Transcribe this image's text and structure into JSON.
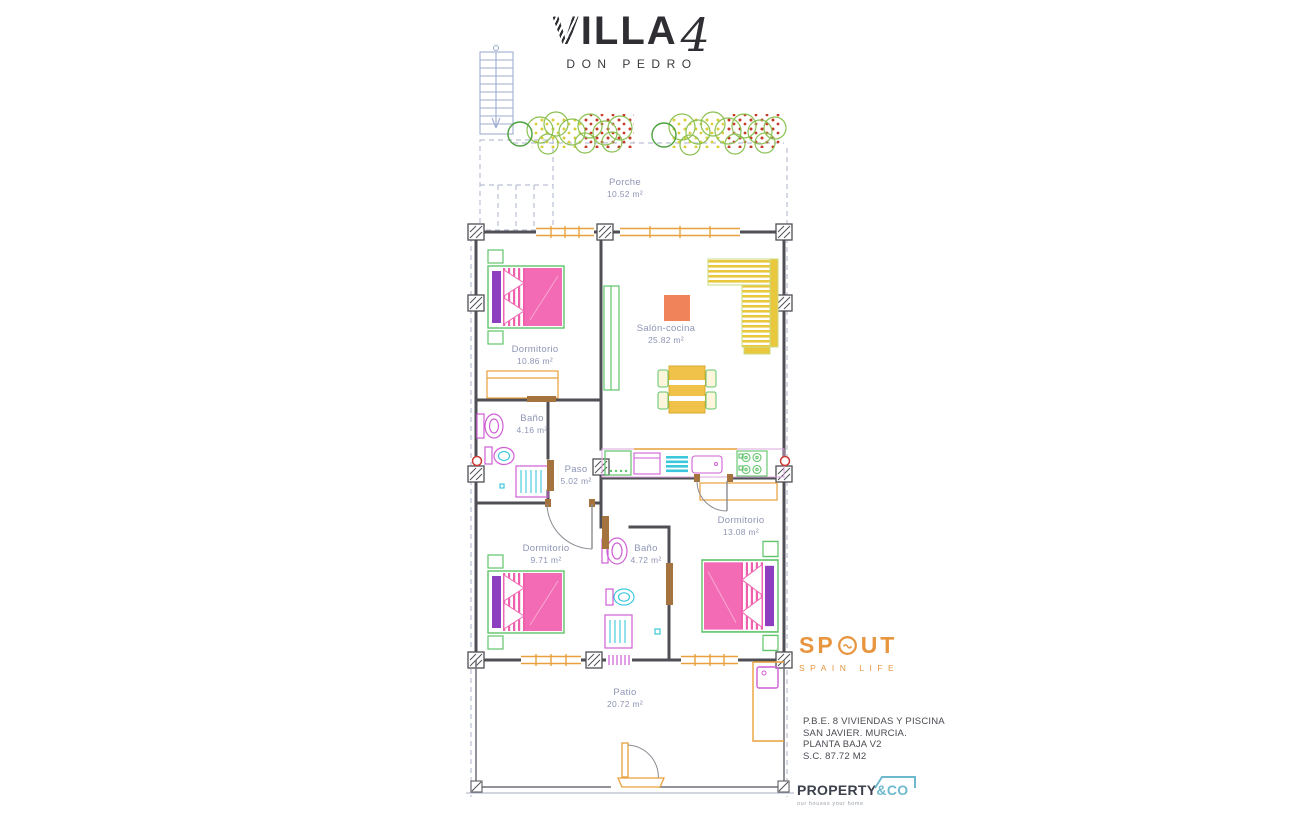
{
  "title": {
    "villa": "VILLA",
    "number": "4",
    "subtitle": "DON PEDRO"
  },
  "rooms": [
    {
      "name": "Porche",
      "area": "10.52 m²"
    },
    {
      "name": "Dormitorio",
      "area": "10.86 m²"
    },
    {
      "name": "Salón-cocina",
      "area": "25.82 m²"
    },
    {
      "name": "Baño",
      "area": "4.16 m²"
    },
    {
      "name": "Paso",
      "area": "5.02 m²"
    },
    {
      "name": "Dormitorio",
      "area": "13.08 m²"
    },
    {
      "name": "Dormitorio",
      "area": "9.71 m²"
    },
    {
      "name": "Baño",
      "area": "4.72 m²"
    },
    {
      "name": "Patio",
      "area": "20.72 m²"
    }
  ],
  "branding": {
    "spout": {
      "word_start": "SP",
      "word_end": "UT",
      "tagline": "SPAIN LIFE",
      "color": "#E8953F"
    },
    "property": {
      "name": "PROPERTY",
      "suffix": "&CO",
      "tagline": "our houses your home",
      "accent": "#6FB9CF",
      "text_color": "#3C414D"
    }
  },
  "project_info": {
    "lines": [
      "P.B.E. 8 VIVIENDAS Y PISCINA",
      "SAN JAVIER. MURCIA.",
      "PLANTA BAJA V2",
      "S.C. 87.72 M2"
    ]
  },
  "plan_colors": {
    "wall": "#4F4F55",
    "bed_pink": "#F26BB4",
    "headboard_purple": "#8D3FC0",
    "furniture_green": "#5FC46A",
    "sofa_yellow": "#E9C83E",
    "window_orange": "#E8A13C",
    "fixture_magenta": "#CF5FD4",
    "water_cyan": "#3BC8DC",
    "label_blue": "#8F95B5",
    "boundary": "#B9C0D4",
    "drain_red": "#CC3B33",
    "door_brown": "#A5733D",
    "table_salmon": "#F0835A"
  }
}
